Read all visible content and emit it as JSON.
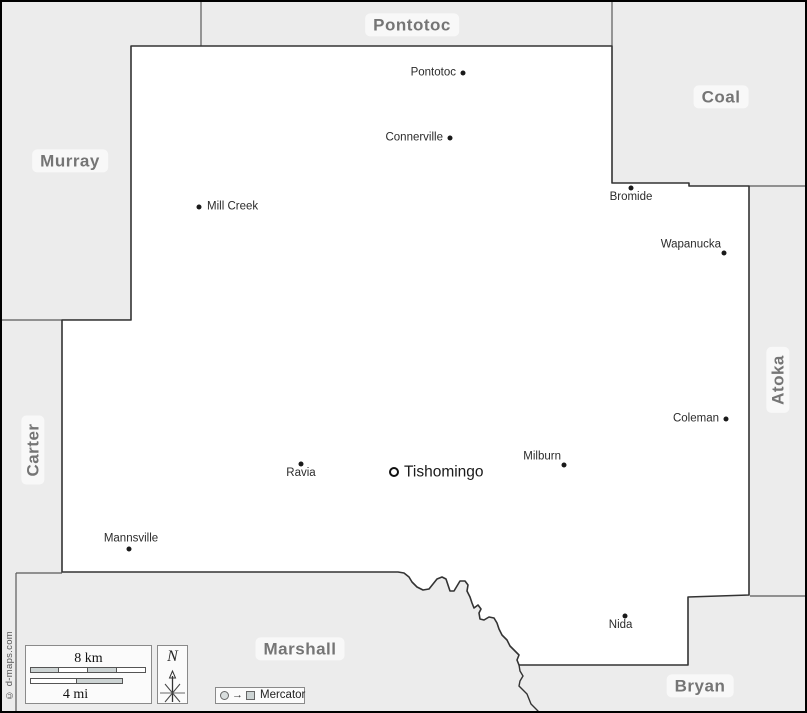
{
  "colors": {
    "neighbor_fill": "#ececec",
    "county_fill": "#ffffff",
    "county_border": "#333333",
    "neighbor_border": "#5a5a5a",
    "county_label": "#757575",
    "town_text": "#2b2b2b"
  },
  "neighbor_counties": [
    {
      "name": "Pontotoc",
      "x": 410,
      "y": 23,
      "rotated": false
    },
    {
      "name": "Coal",
      "x": 719,
      "y": 95,
      "rotated": false
    },
    {
      "name": "Murray",
      "x": 68,
      "y": 159,
      "rotated": false
    },
    {
      "name": "Carter",
      "x": 31,
      "y": 448,
      "rotated": true
    },
    {
      "name": "Atoka",
      "x": 776,
      "y": 378,
      "rotated": true
    },
    {
      "name": "Marshall",
      "x": 298,
      "y": 647,
      "rotated": false
    },
    {
      "name": "Bryan",
      "x": 698,
      "y": 684,
      "rotated": false
    }
  ],
  "towns": [
    {
      "name": "Pontotoc",
      "x": 461,
      "y": 71,
      "label_side": "left",
      "seat": false
    },
    {
      "name": "Connerville",
      "x": 448,
      "y": 136,
      "label_side": "left",
      "seat": false
    },
    {
      "name": "Mill Creek",
      "x": 197,
      "y": 205,
      "label_side": "right",
      "seat": false
    },
    {
      "name": "Bromide",
      "x": 629,
      "y": 186,
      "label_side": "below",
      "seat": false
    },
    {
      "name": "Wapanucka",
      "x": 722,
      "y": 251,
      "label_side": "above-left",
      "seat": false
    },
    {
      "name": "Coleman",
      "x": 724,
      "y": 417,
      "label_side": "left",
      "seat": false
    },
    {
      "name": "Milburn",
      "x": 562,
      "y": 463,
      "label_side": "above-left",
      "seat": false
    },
    {
      "name": "Tishomingo",
      "x": 392,
      "y": 470,
      "label_side": "right",
      "seat": true
    },
    {
      "name": "Ravia",
      "x": 299,
      "y": 462,
      "label_side": "below",
      "seat": false
    },
    {
      "name": "Mannsville",
      "x": 127,
      "y": 547,
      "label_side": "above",
      "seat": false
    },
    {
      "name": "Nida",
      "x": 623,
      "y": 614,
      "label_side": "below-left",
      "seat": false
    }
  ],
  "scale_bar": {
    "km_label": "8 km",
    "mi_label": "4 mi"
  },
  "north_indicator": {
    "letter": "N"
  },
  "projection": {
    "label": "Mercator"
  },
  "copyright": "© d-maps.com"
}
